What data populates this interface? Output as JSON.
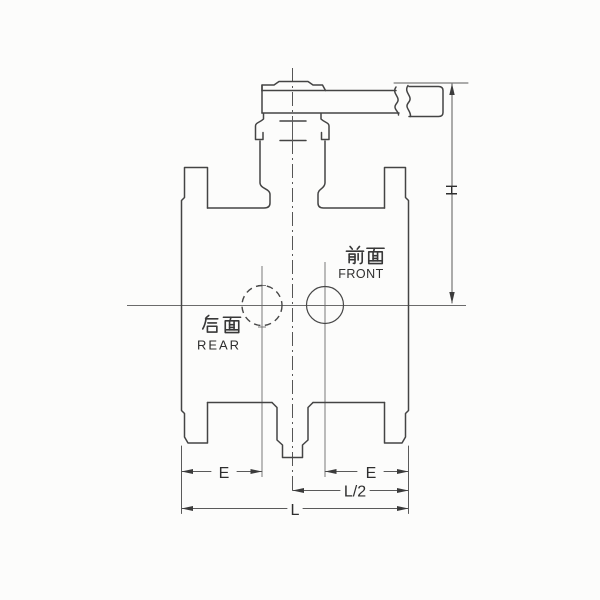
{
  "drawing": {
    "labels": {
      "front_cn": "前面",
      "front_en": "FRONT",
      "rear_cn": "后面",
      "rear_en": "REAR"
    },
    "dimensions": {
      "H": {
        "label": "H"
      },
      "E_left": {
        "label": "E"
      },
      "E_right": {
        "label": "E"
      },
      "half_L": {
        "label": "L/2"
      },
      "L": {
        "label": "L"
      }
    },
    "colors": {
      "line": "#444444",
      "thin_line": "#6b6b6b",
      "text": "#2e2e2e",
      "background": "#fcfcfb"
    }
  }
}
